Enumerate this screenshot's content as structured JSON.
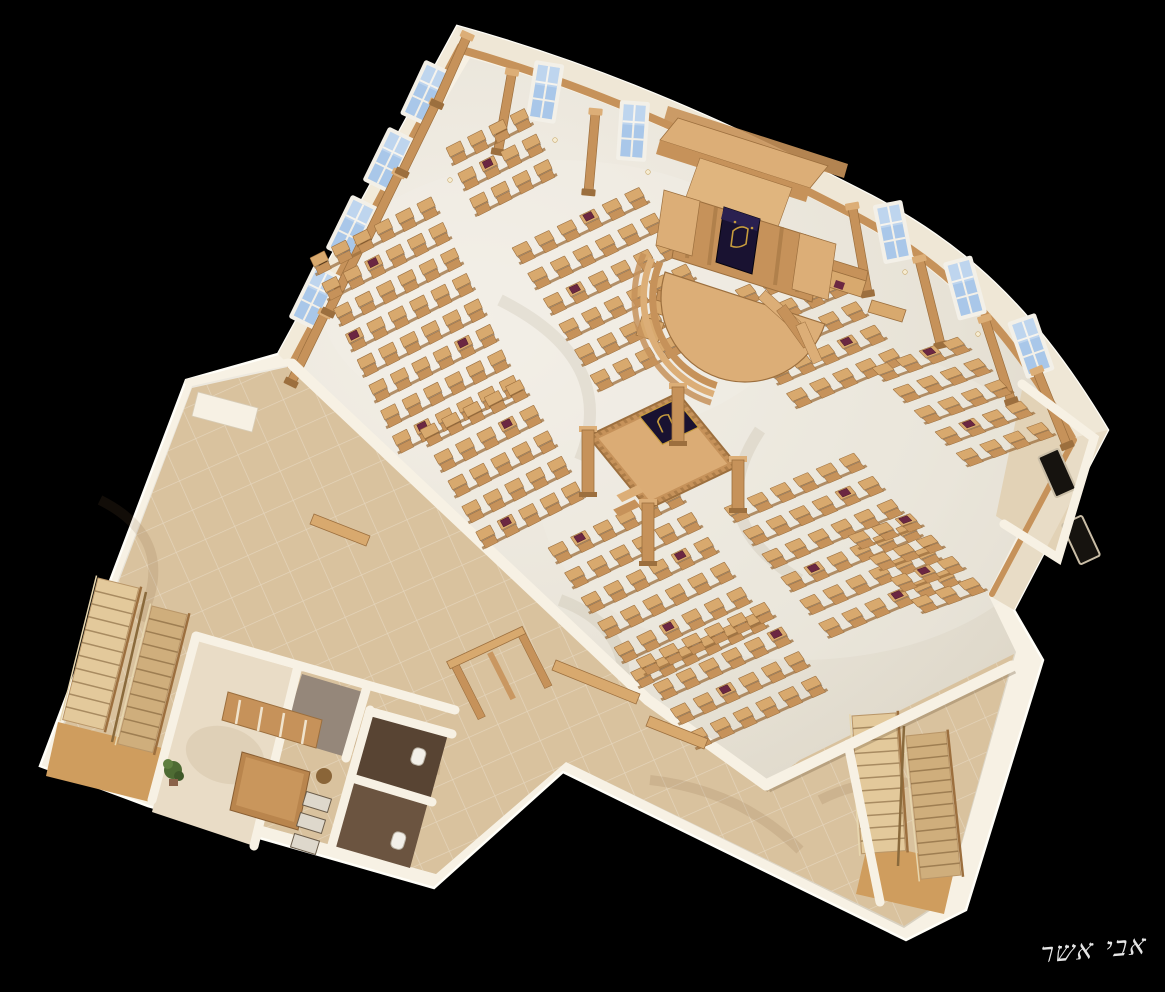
{
  "signature": {
    "text": "אבי אשר"
  },
  "colors": {
    "bg": "#000000",
    "wall_white": "#f7f1e4",
    "wall_cream": "#efe7d6",
    "wall_shade": "#e3d8c2",
    "marble": "#e7e2d7",
    "marble_light": "#f2eee5",
    "lobby_tile": "#d9c29e",
    "corridor": "#e2d2b6",
    "office_floor": "#e9dcc6",
    "grey_room": "#95877a",
    "wood": "#c6925a",
    "wood_light": "#dcae77",
    "wood_dark": "#9c6f3e",
    "wood_desk": "#d8a96e",
    "navy": "#191231",
    "gold": "#c69c3d",
    "book": "#6b2742",
    "bath_dark": "#584433",
    "bath_mid": "#6b5440",
    "stair_light": "#e3c99b",
    "stair_mid": "#cfae7c",
    "landing": "#cf9d5e",
    "window_blue": "#a9c7e9",
    "window_frame": "#f3f0e8",
    "plant_green": "#4e6b33",
    "signature": "#f2f2f2"
  },
  "scene": {
    "pew_blocks": [
      {
        "x": 310,
        "y": 258,
        "cols": 6,
        "rows": 8,
        "sx": 24,
        "sy": 28,
        "ax": 0.89,
        "ay": -0.45,
        "bx": 0.42,
        "by": 0.91,
        "books": [
          [
            1,
            2
          ],
          [
            3,
            0
          ],
          [
            5,
            4
          ],
          [
            7,
            1
          ]
        ]
      },
      {
        "x": 446,
        "y": 148,
        "cols": 4,
        "rows": 3,
        "sx": 24,
        "sy": 28,
        "ax": 0.89,
        "ay": -0.45,
        "bx": 0.42,
        "by": 0.91,
        "books": [
          [
            1,
            1
          ]
        ]
      },
      {
        "x": 512,
        "y": 248,
        "cols": 6,
        "rows": 6,
        "sx": 25,
        "sy": 30,
        "ax": 0.9,
        "ay": -0.43,
        "bx": 0.52,
        "by": 0.85,
        "books": [
          [
            0,
            3
          ],
          [
            2,
            1
          ],
          [
            4,
            4
          ]
        ]
      },
      {
        "x": 712,
        "y": 300,
        "cols": 5,
        "rows": 5,
        "sx": 25,
        "sy": 30,
        "ax": 0.92,
        "ay": -0.39,
        "bx": 0.62,
        "by": 0.78,
        "books": [
          [
            1,
            1
          ],
          [
            3,
            3
          ]
        ]
      },
      {
        "x": 872,
        "y": 368,
        "cols": 4,
        "rows": 5,
        "sx": 25,
        "sy": 30,
        "ax": 0.94,
        "ay": -0.34,
        "bx": 0.7,
        "by": 0.71,
        "books": [
          [
            0,
            2
          ],
          [
            3,
            1
          ]
        ]
      },
      {
        "x": 420,
        "y": 430,
        "cols": 5,
        "rows": 5,
        "sx": 24,
        "sy": 29,
        "ax": 0.89,
        "ay": -0.45,
        "bx": 0.48,
        "by": 0.88,
        "books": [
          [
            1,
            3
          ],
          [
            4,
            1
          ]
        ]
      },
      {
        "x": 548,
        "y": 548,
        "cols": 6,
        "rows": 6,
        "sx": 25,
        "sy": 30,
        "ax": 0.9,
        "ay": -0.43,
        "bx": 0.55,
        "by": 0.83,
        "books": [
          [
            0,
            1
          ],
          [
            2,
            4
          ],
          [
            4,
            2
          ]
        ]
      },
      {
        "x": 724,
        "y": 508,
        "cols": 6,
        "rows": 6,
        "sx": 25,
        "sy": 30,
        "ax": 0.92,
        "ay": -0.39,
        "bx": 0.63,
        "by": 0.77,
        "books": [
          [
            1,
            4
          ],
          [
            3,
            1
          ],
          [
            5,
            3
          ]
        ]
      },
      {
        "x": 848,
        "y": 536,
        "cols": 3,
        "rows": 4,
        "sx": 25,
        "sy": 30,
        "ax": 0.94,
        "ay": -0.34,
        "bx": 0.7,
        "by": 0.71,
        "books": [
          [
            0,
            2
          ],
          [
            2,
            1
          ]
        ]
      },
      {
        "x": 636,
        "y": 660,
        "cols": 6,
        "rows": 4,
        "sx": 25,
        "sy": 30,
        "ax": 0.91,
        "ay": -0.41,
        "bx": 0.57,
        "by": 0.82,
        "books": [
          [
            1,
            5
          ],
          [
            2,
            2
          ]
        ]
      }
    ],
    "windows": [
      {
        "x": 315,
        "y": 297,
        "rot": 26
      },
      {
        "x": 352,
        "y": 228,
        "rot": 26
      },
      {
        "x": 389,
        "y": 160,
        "rot": 26
      },
      {
        "x": 426,
        "y": 93,
        "rot": 25
      },
      {
        "x": 545,
        "y": 92,
        "rot": 9
      },
      {
        "x": 633,
        "y": 131,
        "rot": 4
      },
      {
        "x": 893,
        "y": 232,
        "rot": -11
      },
      {
        "x": 965,
        "y": 288,
        "rot": -15
      },
      {
        "x": 1031,
        "y": 346,
        "rot": -19
      },
      {
        "x": 1057,
        "y": 473,
        "rot": -24,
        "dark": true
      },
      {
        "x": 1081,
        "y": 540,
        "rot": -25,
        "dark": true
      }
    ],
    "pilasters": [
      {
        "x": 308,
        "y": 348,
        "rot": 26,
        "len": 72
      },
      {
        "x": 345,
        "y": 278,
        "rot": 26,
        "len": 72
      },
      {
        "x": 382,
        "y": 208,
        "rot": 26,
        "len": 72
      },
      {
        "x": 419,
        "y": 138,
        "rot": 26,
        "len": 72
      },
      {
        "x": 452,
        "y": 70,
        "rot": 24,
        "len": 70
      },
      {
        "x": 505,
        "y": 112,
        "rot": 10,
        "len": 76
      },
      {
        "x": 592,
        "y": 152,
        "rot": 5,
        "len": 76
      },
      {
        "x": 860,
        "y": 250,
        "rot": -10,
        "len": 84
      },
      {
        "x": 930,
        "y": 302,
        "rot": -14,
        "len": 84
      },
      {
        "x": 998,
        "y": 360,
        "rot": -18,
        "len": 82
      },
      {
        "x": 1052,
        "y": 408,
        "rot": -22,
        "len": 76
      }
    ],
    "sconces": [
      [
        450,
        180
      ],
      [
        555,
        140
      ],
      [
        648,
        172
      ],
      [
        905,
        272
      ],
      [
        978,
        334
      ]
    ],
    "stair_flights": [
      {
        "x": 98,
        "y": 578,
        "rot": 14,
        "w": 42,
        "len": 146,
        "steps": 11,
        "tone": "light"
      },
      {
        "x": 152,
        "y": 606,
        "rot": 14,
        "w": 36,
        "len": 142,
        "steps": 11,
        "tone": "mid"
      },
      {
        "x": 852,
        "y": 716,
        "rot": -4,
        "w": 44,
        "len": 138,
        "steps": 11,
        "tone": "light"
      },
      {
        "x": 906,
        "y": 736,
        "rot": -6,
        "w": 40,
        "len": 144,
        "steps": 12,
        "tone": "mid"
      }
    ],
    "benches": [
      {
        "d": "M658,290 L716,308 L714,318 L656,300 Z",
        "tone": "dark"
      },
      {
        "d": "M656,300 L714,318 L710,330 L652,312 Z"
      },
      {
        "d": "M642,316 L664,323 L658,342 L636,335 Z"
      },
      {
        "d": "M826,258 L868,271 L866,281 L824,268 Z",
        "tone": "dark"
      },
      {
        "d": "M824,268 L866,281 L861,297 L819,284 Z",
        "book": [
          836,
          280
        ]
      },
      {
        "d": "M872,300 L906,310 L902,322 L868,312 Z"
      },
      {
        "d": "M556,660 L640,694 L636,704 L552,670 Z"
      },
      {
        "d": "M650,716 L708,739 L704,749 L646,726 Z"
      },
      {
        "d": "M314,514 L370,536 L366,546 L310,524 Z"
      },
      {
        "d": "M198,392 L258,408 L252,432 L192,416 Z",
        "tone": "white"
      }
    ]
  }
}
